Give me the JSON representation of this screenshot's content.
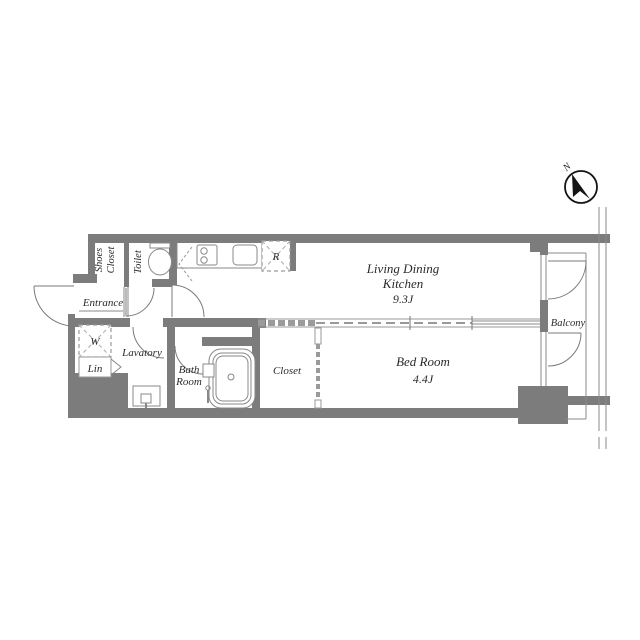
{
  "floorplan": {
    "compass": {
      "north_label": "N"
    },
    "rooms": {
      "ldk": {
        "name_line1": "Living Dining",
        "name_line2": "Kitchen",
        "size": "9.3J"
      },
      "bedroom": {
        "name": "Bed Room",
        "size": "4.4J"
      },
      "closet": {
        "name": "Closet"
      },
      "balcony": {
        "name": "Balcony"
      },
      "bathroom": {
        "name_line1": "Bath",
        "name_line2": "Room"
      },
      "lavatory": {
        "name": "Lavatory"
      },
      "toilet": {
        "name": "Toilet"
      },
      "shoes_closet": {
        "name_line1": "Shoes",
        "name_line2": "Closet"
      },
      "entrance": {
        "name": "Entrance"
      },
      "washer_space": {
        "name": "W"
      },
      "linen": {
        "name": "Lin"
      },
      "refrigerator_space": {
        "name": "R"
      }
    },
    "colors": {
      "wall": "#7c7c7c",
      "line": "#8a8a8a",
      "text": "#2a2a2a",
      "background": "#ffffff",
      "compass_needle": "#151515"
    }
  }
}
